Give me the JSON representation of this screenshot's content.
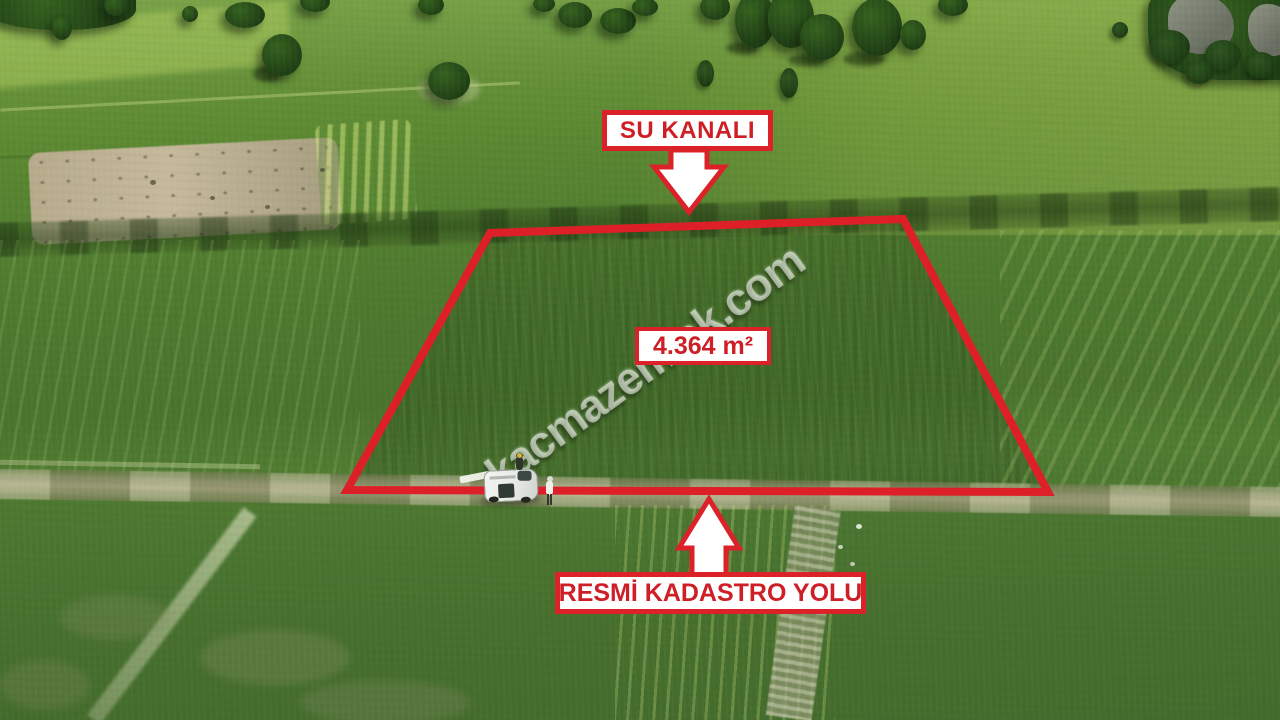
{
  "image": {
    "kind": "aerial-drone-photo-of-farmland-for-sale",
    "watermark": "kacmazemlak.com",
    "accent_red": "#da2228",
    "label_background": "#ffffff",
    "label_text_color": "#ce1f26"
  },
  "annotations": {
    "top_label": "SU KANALI",
    "top_arrow_icon": "arrow-down",
    "area_label": "4.364 m²",
    "bottom_arrow_icon": "arrow-up",
    "bottom_label": "RESMİ KADASTRO YOLU",
    "parcel_outline_color": "#dd2027"
  },
  "scene": {
    "parcel_shape": "red trapezoid outline",
    "vehicle": "white van parked on dirt road at bottom edge of parcel",
    "road": "horizontal dirt track across image below parcel",
    "surroundings": "green crop fields, scattered trees, forest at top corners, tan plowed patch upper left"
  }
}
